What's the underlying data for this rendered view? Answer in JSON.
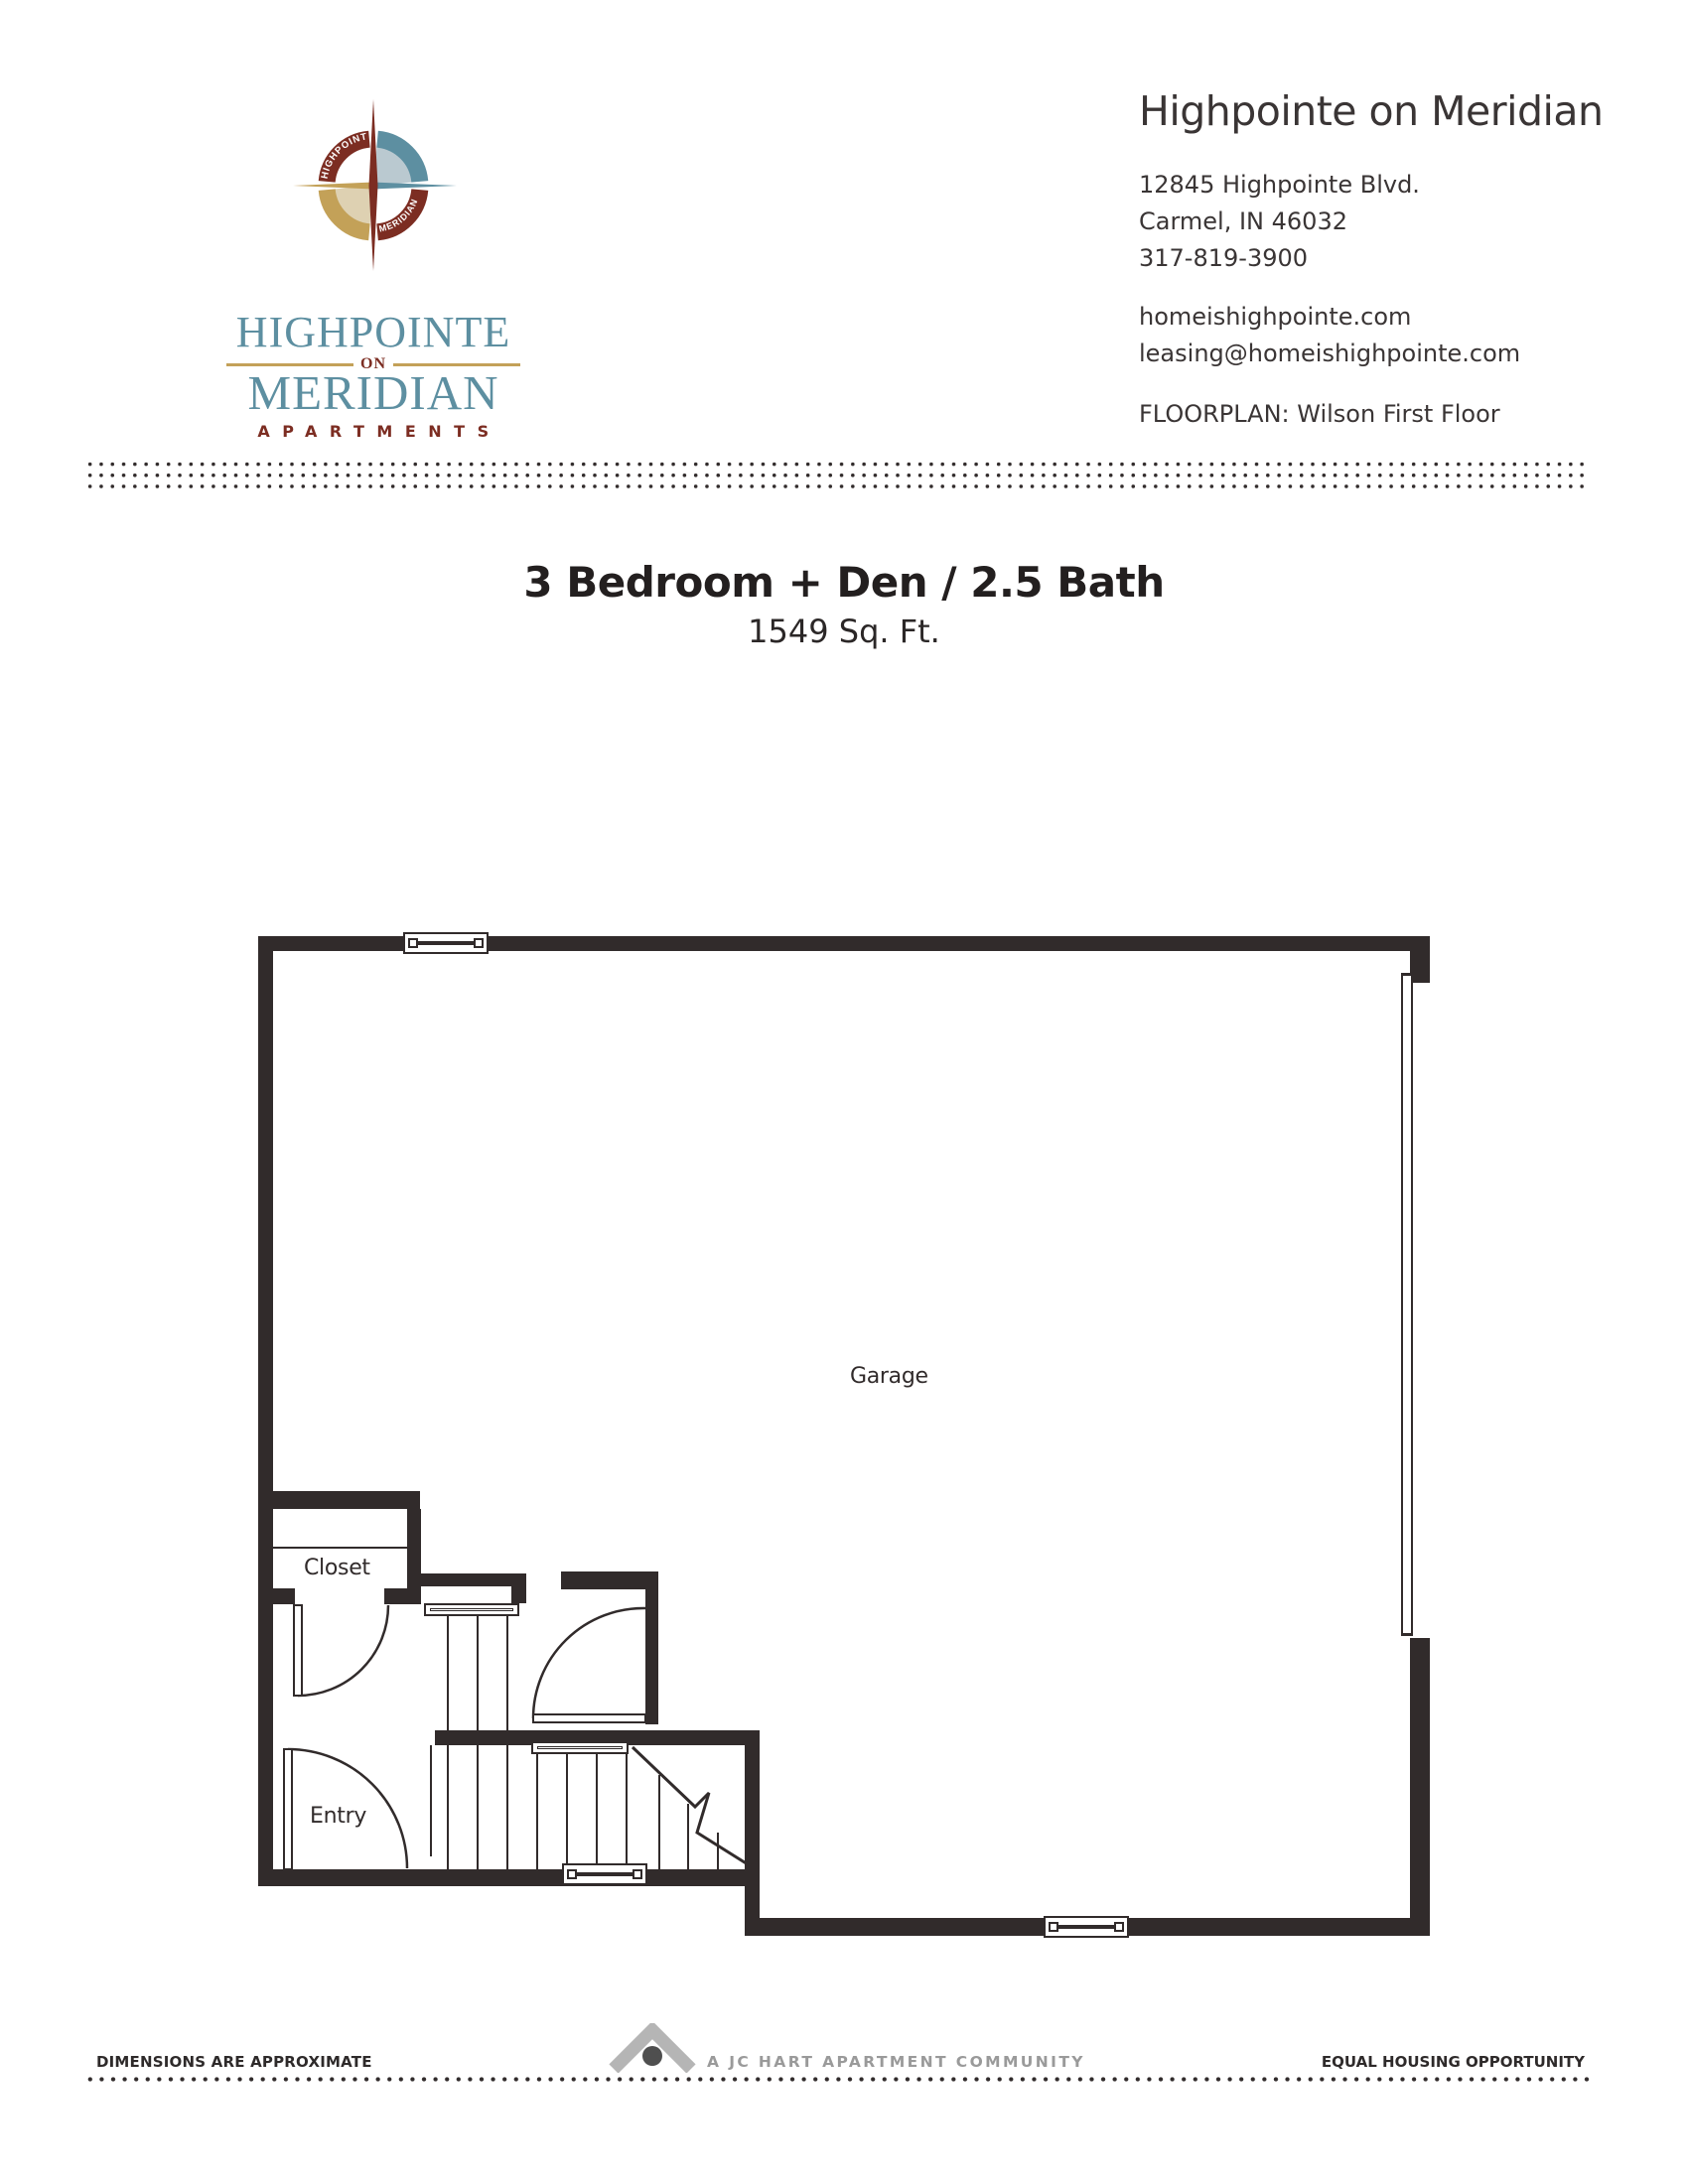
{
  "colors": {
    "ink": "#312b2b",
    "teal": "#5d8fa1",
    "maroon": "#7c2d22",
    "gold": "#c3a158",
    "pale_blue": "#bac9d0",
    "pale_tan": "#ded1b2",
    "footer_gray": "#9a9a9a"
  },
  "brand": {
    "wordmark_line1": "HIGHPOINTE",
    "wordmark_on": "ON",
    "wordmark_line2": "MERIDIAN",
    "wordmark_line3": "APARTMENTS",
    "ring_top": "HIGHPOINTE",
    "ring_bottom": "MERIDIAN"
  },
  "header": {
    "property_name": "Highpointe on Meridian",
    "address_line1": "12845 Highpointe Blvd.",
    "address_line2": "Carmel, IN 46032",
    "phone": "317-819-3900",
    "website": "homeishighpointe.com",
    "email": "leasing@homeishighpointe.com",
    "floorplan_label": "FLOORPLAN: Wilson First Floor"
  },
  "plan": {
    "title": "3 Bedroom + Den / 2.5 Bath",
    "sqft": "1549 Sq. Ft.",
    "rooms": {
      "garage": "Garage",
      "closet": "Closet",
      "entry": "Entry"
    }
  },
  "footer": {
    "left_note": "DIMENSIONS ARE APPROXIMATE",
    "community": "A JC HART APARTMENT COMMUNITY",
    "right_note": "EQUAL HOUSING OPPORTUNITY"
  }
}
